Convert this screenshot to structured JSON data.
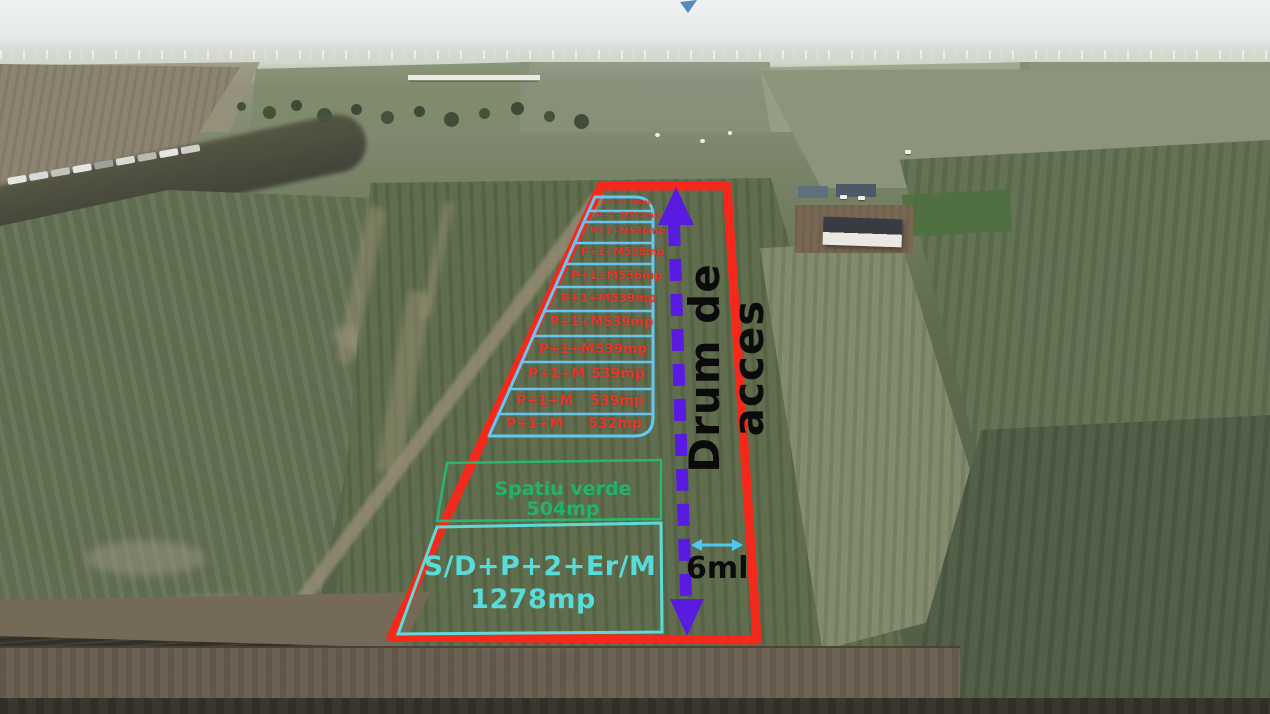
{
  "photo": {
    "type": "aerial-drone-photo-of-farmland",
    "description": "Drone view of agricultural fields with land parcels marked for sale"
  },
  "overlay": {
    "boundary_color": "#f5291b",
    "parcels": {
      "line_color": "#66c6f2",
      "text_color": "#e6372b",
      "items": [
        {
          "label": "P+1+M",
          "area": "504mp"
        },
        {
          "label": "P+1+M",
          "area": "512mp"
        },
        {
          "label": "P+1+M",
          "area": "536mp"
        },
        {
          "label": "P+1+M",
          "area": "538mp"
        },
        {
          "label": "P+1+M",
          "area": "536mp"
        },
        {
          "label": "P+1+M",
          "area": "539mp"
        },
        {
          "label": "P+1+M",
          "area": "539mp"
        },
        {
          "label": "P+1+M",
          "area": "539mp"
        },
        {
          "label": "P+1+M",
          "area": "539mp"
        },
        {
          "label": "P+1+M",
          "area": "539mp"
        },
        {
          "label": "P+1+M",
          "area": "532mp"
        }
      ]
    },
    "green_space": {
      "label": "Spatiu verde 504mp",
      "color": "#22b26d"
    },
    "main_building_plot": {
      "line1": "S/D+P+2+Er/M",
      "line2": "1278mp",
      "color": "#58dcd9"
    },
    "access_road": {
      "label": "Drum de acces",
      "arrow_color": "#5a1be0",
      "label_color": "#0b0b0b"
    },
    "road_width": {
      "label": "6ml",
      "arrow_color": "#4cc9f1"
    }
  }
}
